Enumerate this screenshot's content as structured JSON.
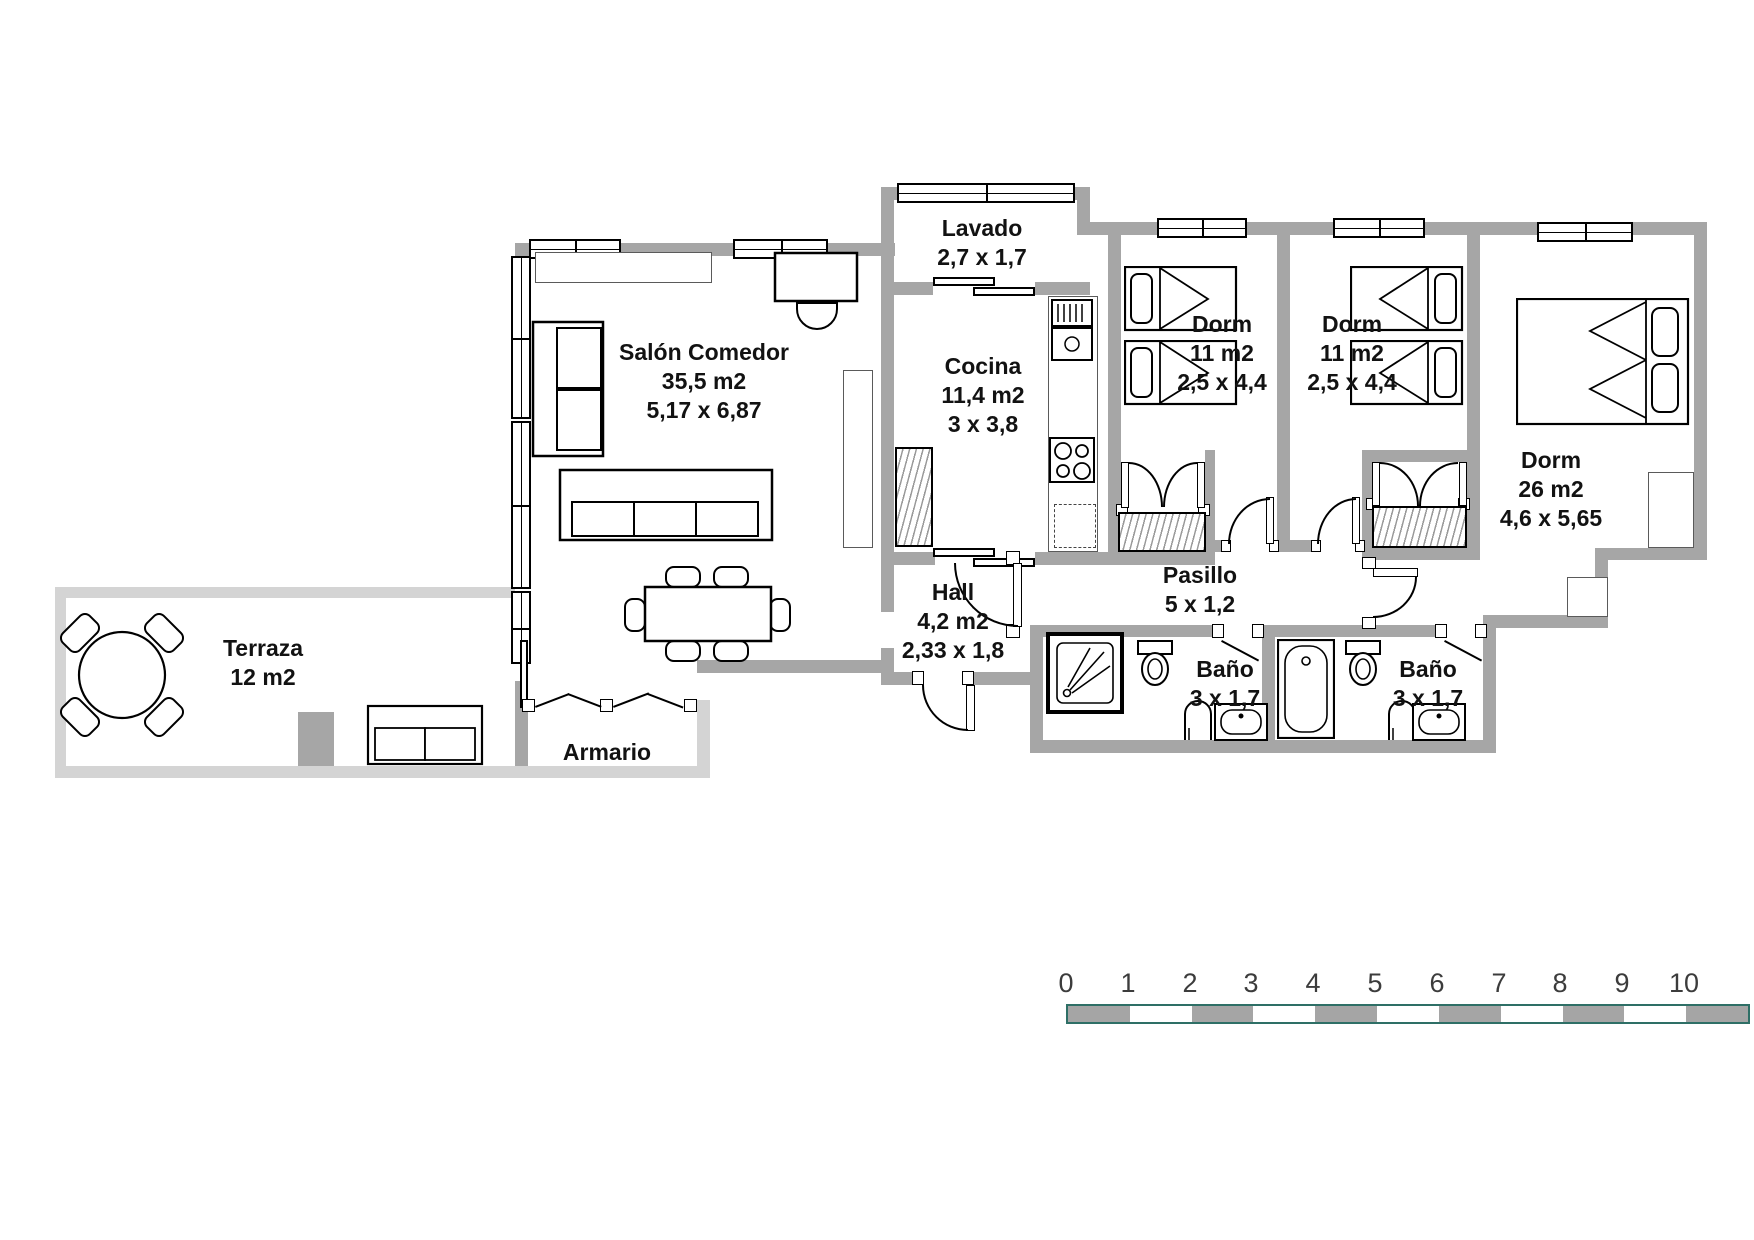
{
  "title": "apartment-floor-plan",
  "rooms": {
    "salon": {
      "name": "Salón Comedor",
      "area": "35,5 m2",
      "dims": "5,17 x 6,87"
    },
    "lavado": {
      "name": "Lavado",
      "area": "",
      "dims": "2,7 x 1,7"
    },
    "cocina": {
      "name": "Cocina",
      "area": "11,4 m2",
      "dims": "3 x 3,8"
    },
    "dorm1": {
      "name": "Dorm",
      "area": "11 m2",
      "dims": "2,5 x 4,4"
    },
    "dorm2": {
      "name": "Dorm",
      "area": "11 m2",
      "dims": "2,5 x 4,4"
    },
    "dorm3": {
      "name": "Dorm",
      "area": "26 m2",
      "dims": "4,6 x 5,65"
    },
    "hall": {
      "name": "Hall",
      "area": "4,2 m2",
      "dims": "2,33 x 1,8"
    },
    "pasillo": {
      "name": "Pasillo",
      "area": "",
      "dims": "5 x 1,2"
    },
    "bano1": {
      "name": "Baño",
      "area": "",
      "dims": "3 x 1,7"
    },
    "bano2": {
      "name": "Baño",
      "area": "",
      "dims": "3 x 1,7"
    },
    "terraza": {
      "name": "Terraza",
      "area": "12 m2",
      "dims": ""
    },
    "armario": {
      "name": "Armario",
      "area": "",
      "dims": ""
    }
  },
  "scale": {
    "ticks": [
      "0",
      "1",
      "2",
      "3",
      "4",
      "5",
      "6",
      "7",
      "8",
      "9",
      "10"
    ],
    "outline_color": "#2e6f66",
    "segment_gray": "#a5a5a5"
  },
  "colors": {
    "interior_wall": "#a6a6a6",
    "terrace_wall": "#d4d4d4",
    "line": "#000000"
  }
}
